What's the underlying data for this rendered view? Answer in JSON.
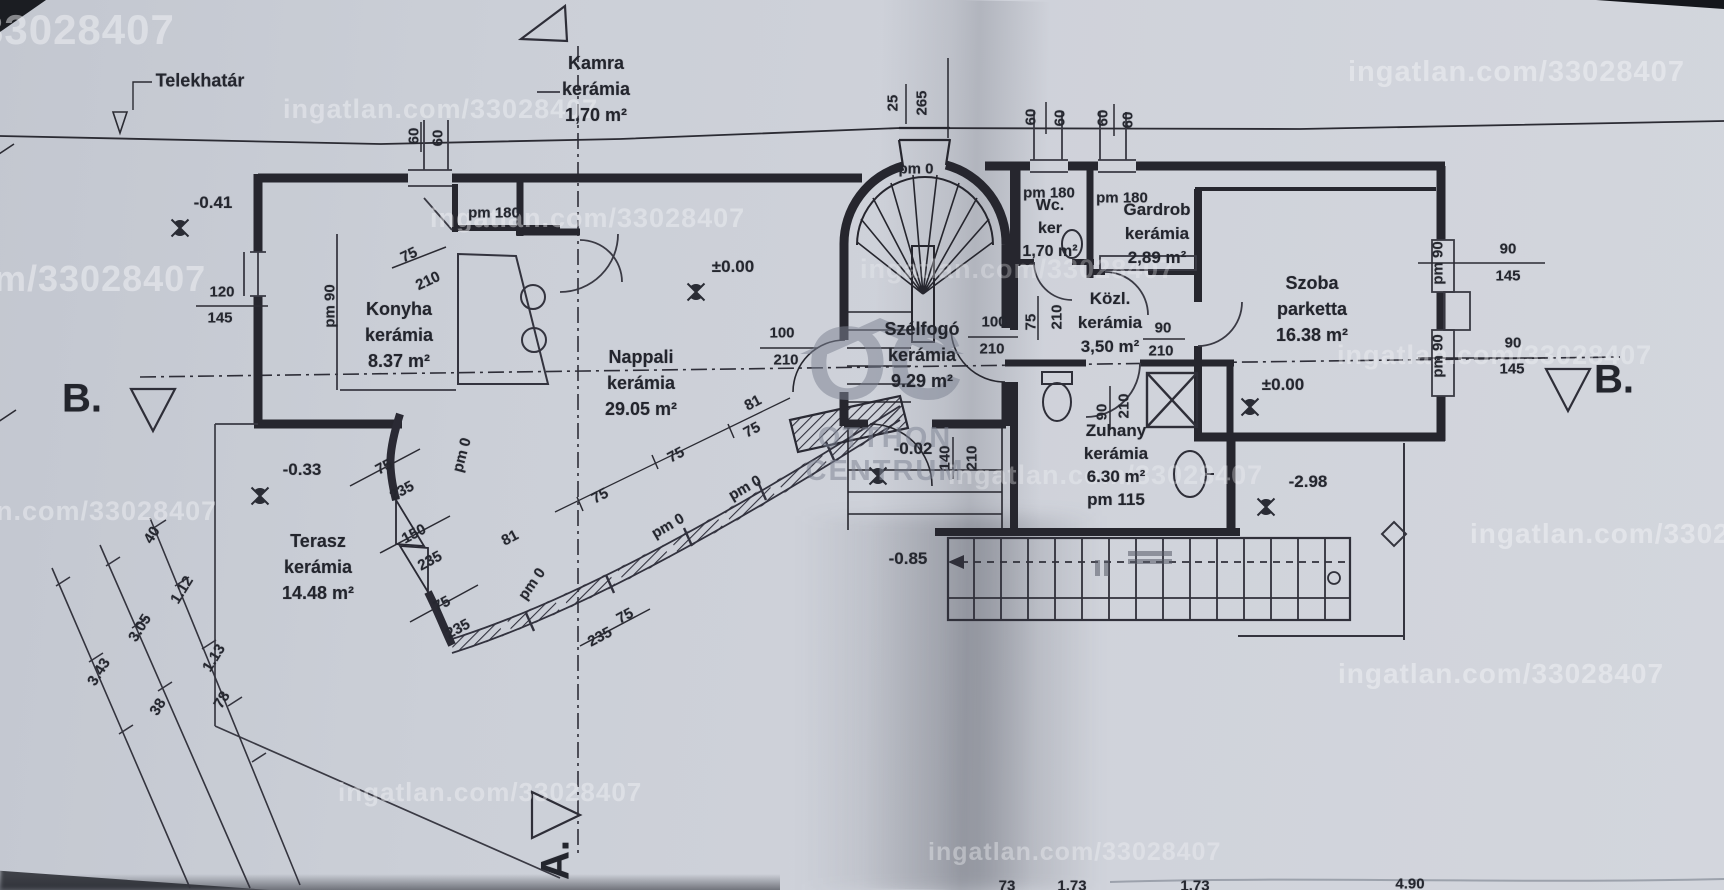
{
  "boundary": {
    "label": "Telekhatár"
  },
  "sections": {
    "left": "B.",
    "right": "B.",
    "bottom": "A."
  },
  "logo": {
    "monogram": "OC",
    "line1": "OTTHON",
    "line2": "CENTRUM"
  },
  "watermark_color": "#f2f3f6",
  "watermarks": [
    {
      "t": "33028407",
      "x": -20,
      "y": 6,
      "fs": 42,
      "op": 0.5
    },
    {
      "t": "ingatlan.com/33028407",
      "x": 283,
      "y": 94,
      "fs": 27,
      "op": 0.46
    },
    {
      "t": "ingatlan.com/33028407",
      "x": 1348,
      "y": 56,
      "fs": 29,
      "op": 0.5
    },
    {
      "t": "ingatlan.com/33028407",
      "x": 430,
      "y": 203,
      "fs": 27,
      "op": 0.44
    },
    {
      "t": "m/33028407",
      "x": -6,
      "y": 258,
      "fs": 36,
      "op": 0.5
    },
    {
      "t": "ingatlan.com/33028407",
      "x": 860,
      "y": 254,
      "fs": 27,
      "op": 0.3
    },
    {
      "t": "n.com/33028407",
      "x": -4,
      "y": 496,
      "fs": 27,
      "op": 0.46
    },
    {
      "t": "ingatlan.com/33028407",
      "x": 948,
      "y": 460,
      "fs": 27,
      "op": 0.34
    },
    {
      "t": "ingatlan.com/33028407",
      "x": 1470,
      "y": 518,
      "fs": 28,
      "op": 0.5
    },
    {
      "t": "ingatlan.com/33028407",
      "x": 1337,
      "y": 340,
      "fs": 27,
      "op": 0.4
    },
    {
      "t": "ingatlan.com/33028407",
      "x": 1338,
      "y": 658,
      "fs": 28,
      "op": 0.5
    },
    {
      "t": "ingatlan.com/33028407",
      "x": 338,
      "y": 777,
      "fs": 26,
      "op": 0.44
    },
    {
      "t": "ingatlan.com/33028407",
      "x": 928,
      "y": 838,
      "fs": 25,
      "op": 0.38
    }
  ],
  "rooms": [
    {
      "cx": 596,
      "y": 50,
      "fs": 18,
      "lh": 26,
      "lines": [
        "Kamra",
        "kerámia",
        "1,70 m²"
      ]
    },
    {
      "cx": 399,
      "y": 296,
      "fs": 18,
      "lh": 26,
      "lines": [
        "Konyha",
        "kerámia",
        "8.37 m²"
      ]
    },
    {
      "cx": 641,
      "y": 344,
      "fs": 18,
      "lh": 26,
      "lines": [
        "Nappali",
        "kerámia",
        "29.05 m²"
      ]
    },
    {
      "cx": 318,
      "y": 528,
      "fs": 18,
      "lh": 26,
      "lines": [
        "Terasz",
        "kerámia",
        "14.48 m²"
      ]
    },
    {
      "cx": 922,
      "y": 316,
      "fs": 18,
      "lh": 26,
      "lines": [
        "Szélfogó",
        "kerámia",
        "9.29 m²"
      ]
    },
    {
      "cx": 1050,
      "y": 194,
      "fs": 16,
      "lh": 23,
      "lines": [
        "Wc.",
        "ker",
        "1,70 m²"
      ]
    },
    {
      "cx": 1157,
      "y": 198,
      "fs": 17,
      "lh": 24,
      "lines": [
        "Gardrob",
        "kerámia",
        "2,89 m²"
      ]
    },
    {
      "cx": 1110,
      "y": 287,
      "fs": 17,
      "lh": 24,
      "lines": [
        "Közl.",
        "kerámia",
        "3,50 m²"
      ]
    },
    {
      "cx": 1312,
      "y": 270,
      "fs": 18,
      "lh": 26,
      "lines": [
        "Szoba",
        "parketta",
        "16.38 m²"
      ]
    },
    {
      "cx": 1116,
      "y": 419,
      "fs": 17,
      "lh": 23,
      "lines": [
        "Zuhany",
        "kerámia",
        "6.30 m²",
        "pm 115"
      ]
    }
  ],
  "dims": [
    {
      "t": "60",
      "x": 414,
      "y": 136,
      "r": -90
    },
    {
      "t": "60",
      "x": 438,
      "y": 138,
      "r": -90
    },
    {
      "t": "25",
      "x": 893,
      "y": 103,
      "r": -90
    },
    {
      "t": "265",
      "x": 922,
      "y": 103,
      "r": -90
    },
    {
      "t": "60",
      "x": 1031,
      "y": 117,
      "r": -90
    },
    {
      "t": "60",
      "x": 1060,
      "y": 118,
      "r": -90
    },
    {
      "t": "60",
      "x": 1103,
      "y": 118,
      "r": -90
    },
    {
      "t": "60",
      "x": 1128,
      "y": 120,
      "r": -90
    },
    {
      "t": "pm 180",
      "x": 494,
      "y": 213
    },
    {
      "t": "75",
      "x": 409,
      "y": 255,
      "r": -25
    },
    {
      "t": "210",
      "x": 428,
      "y": 281,
      "r": -25
    },
    {
      "t": "120",
      "x": 222,
      "y": 292
    },
    {
      "t": "145",
      "x": 220,
      "y": 318
    },
    {
      "t": "pm 90",
      "x": 330,
      "y": 306,
      "r": -90
    },
    {
      "t": "pm 180",
      "x": 1049,
      "y": 193
    },
    {
      "t": "pm 180",
      "x": 1122,
      "y": 198
    },
    {
      "t": "100",
      "x": 782,
      "y": 333
    },
    {
      "t": "210",
      "x": 786,
      "y": 360
    },
    {
      "t": "100",
      "x": 994,
      "y": 322
    },
    {
      "t": "210",
      "x": 992,
      "y": 349
    },
    {
      "t": "75",
      "x": 1031,
      "y": 322,
      "r": -90
    },
    {
      "t": "210",
      "x": 1057,
      "y": 317,
      "r": -90
    },
    {
      "t": "90",
      "x": 1163,
      "y": 328
    },
    {
      "t": "210",
      "x": 1161,
      "y": 351
    },
    {
      "t": "140",
      "x": 945,
      "y": 458,
      "r": -90
    },
    {
      "t": "210",
      "x": 972,
      "y": 458,
      "r": -90
    },
    {
      "t": "90",
      "x": 1102,
      "y": 412,
      "r": -90
    },
    {
      "t": "210",
      "x": 1124,
      "y": 406,
      "r": -90
    },
    {
      "t": "90",
      "x": 1508,
      "y": 249
    },
    {
      "t": "145",
      "x": 1508,
      "y": 276
    },
    {
      "t": "pm 90",
      "x": 1438,
      "y": 263,
      "r": -90
    },
    {
      "t": "90",
      "x": 1513,
      "y": 343
    },
    {
      "t": "145",
      "x": 1512,
      "y": 369
    },
    {
      "t": "pm 90",
      "x": 1438,
      "y": 356,
      "r": -90
    },
    {
      "t": "75",
      "x": 384,
      "y": 467,
      "r": -28
    },
    {
      "t": "235",
      "x": 402,
      "y": 491,
      "r": -28
    },
    {
      "t": "150",
      "x": 414,
      "y": 534,
      "r": -28
    },
    {
      "t": "235",
      "x": 430,
      "y": 561,
      "r": -28
    },
    {
      "t": "75",
      "x": 442,
      "y": 604,
      "r": -28
    },
    {
      "t": "235",
      "x": 458,
      "y": 629,
      "r": -28
    },
    {
      "t": "75",
      "x": 625,
      "y": 616,
      "r": -28
    },
    {
      "t": "235",
      "x": 600,
      "y": 637,
      "r": -28
    },
    {
      "t": "81",
      "x": 510,
      "y": 538,
      "r": -28
    },
    {
      "t": "81",
      "x": 753,
      "y": 403,
      "r": -28
    },
    {
      "t": "75",
      "x": 600,
      "y": 496,
      "r": -28
    },
    {
      "t": "75",
      "x": 676,
      "y": 455,
      "r": -28
    },
    {
      "t": "75",
      "x": 752,
      "y": 430,
      "r": -28
    },
    {
      "t": "pm 0",
      "x": 462,
      "y": 455,
      "r": -75
    },
    {
      "t": "pm 0",
      "x": 532,
      "y": 584,
      "r": -55
    },
    {
      "t": "pm 0",
      "x": 668,
      "y": 526,
      "r": -30
    },
    {
      "t": "pm 0",
      "x": 745,
      "y": 488,
      "r": -30
    },
    {
      "t": "pm 0",
      "x": 916,
      "y": 169
    },
    {
      "t": "40",
      "x": 152,
      "y": 535,
      "r": -58
    },
    {
      "t": "1.12",
      "x": 182,
      "y": 590,
      "r": -58
    },
    {
      "t": "3.05",
      "x": 140,
      "y": 628,
      "r": -58
    },
    {
      "t": "1.13",
      "x": 214,
      "y": 658,
      "r": -58
    },
    {
      "t": "3.43",
      "x": 99,
      "y": 672,
      "r": -58
    },
    {
      "t": "38",
      "x": 158,
      "y": 707,
      "r": -58
    },
    {
      "t": "78",
      "x": 222,
      "y": 700,
      "r": -58
    },
    {
      "t": "73",
      "x": 1007,
      "y": 886
    },
    {
      "t": "1.73",
      "x": 1072,
      "y": 886
    },
    {
      "t": "1.73",
      "x": 1195,
      "y": 886
    },
    {
      "t": "4.90",
      "x": 1410,
      "y": 884
    }
  ],
  "elevations": [
    {
      "t": "-0.41",
      "x": 213,
      "y": 203
    },
    {
      "t": "±0.00",
      "x": 733,
      "y": 267
    },
    {
      "t": "±0.00",
      "x": 1283,
      "y": 385
    },
    {
      "t": "-0.33",
      "x": 302,
      "y": 470
    },
    {
      "t": "-0.02",
      "x": 913,
      "y": 449
    },
    {
      "t": "-2.98",
      "x": 1308,
      "y": 482
    },
    {
      "t": "-0.85",
      "x": 908,
      "y": 559
    }
  ]
}
